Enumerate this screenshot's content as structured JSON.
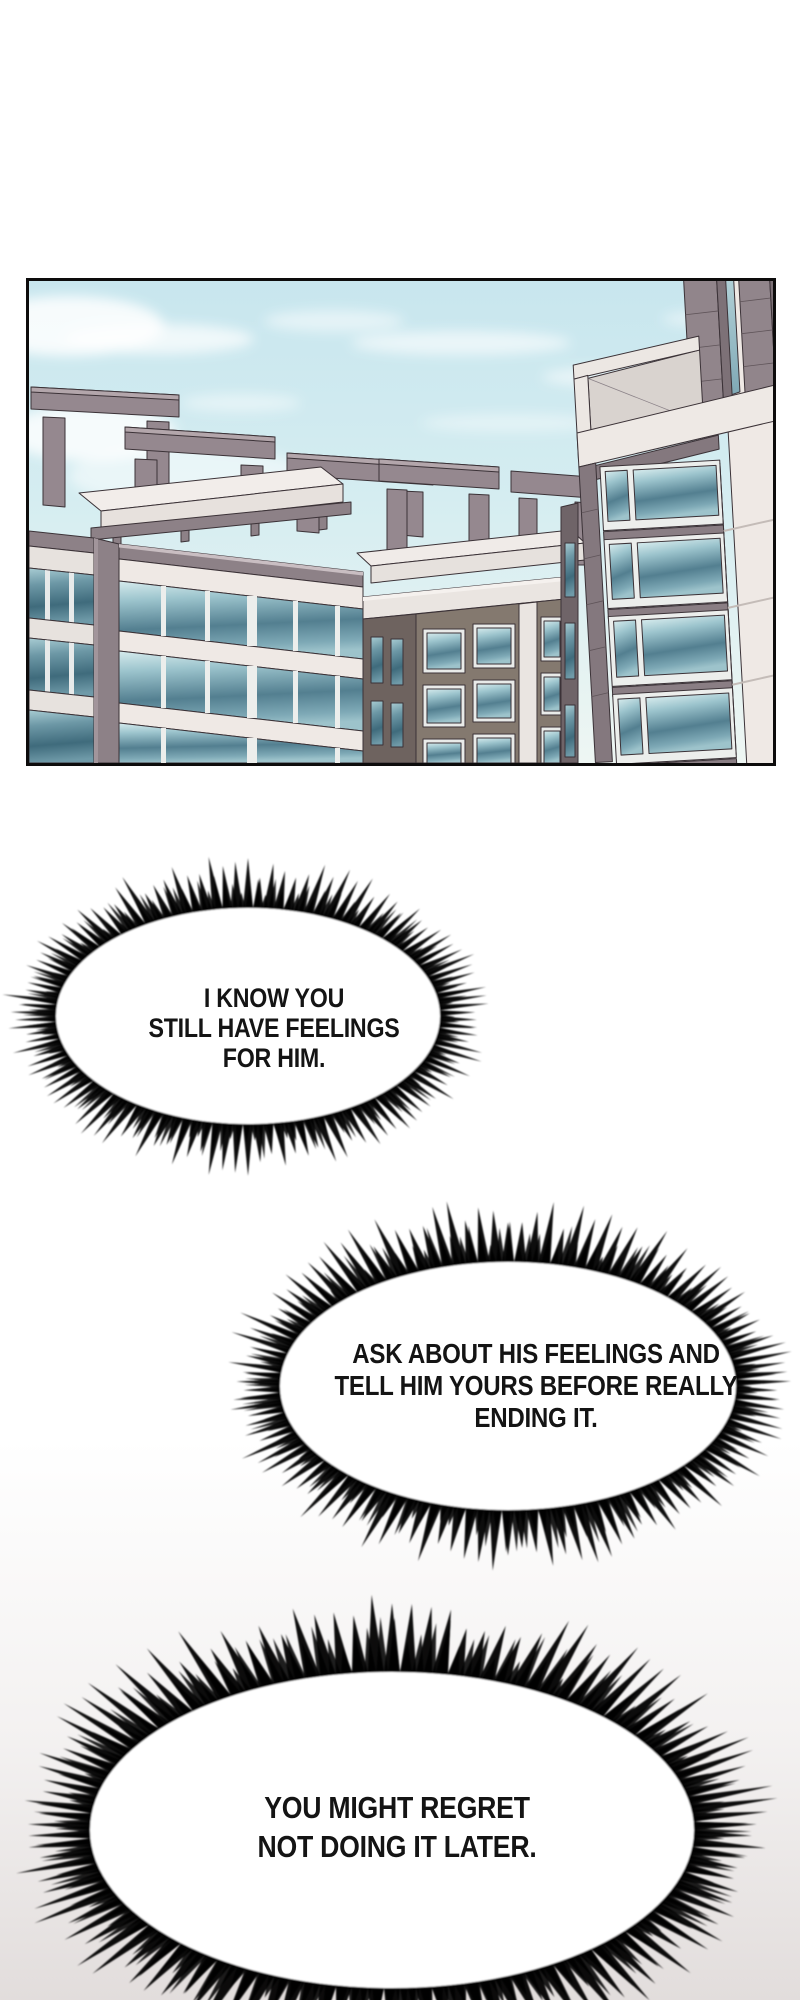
{
  "page": {
    "kind": "webtoon comic page",
    "background_color": "#ffffff",
    "bottom_tint_color": "#e2dddc"
  },
  "panel": {
    "description": "Low-angle view of modern apartment buildings with rooftop concrete frames under a pale blue sky with wispy clouds",
    "border_color": "#0d0c0c",
    "sky_top_color": "#c8e6ee",
    "sky_horizon_color": "#eef6f3",
    "building_mauve_color": "#8d8187",
    "facade_white_color": "#efe9e5",
    "window_teal_color": "#537f90",
    "outline_color": "#3b3237"
  },
  "bubbles": [
    {
      "text": "I KNOW YOU\nSTILL HAVE FEELINGS\nFOR HIM."
    },
    {
      "text": "ASK ABOUT HIS FEELINGS AND\nTELL HIM YOURS BEFORE REALLY\nENDING IT."
    },
    {
      "text": "YOU MIGHT REGRET\nNOT DOING IT LATER."
    }
  ]
}
